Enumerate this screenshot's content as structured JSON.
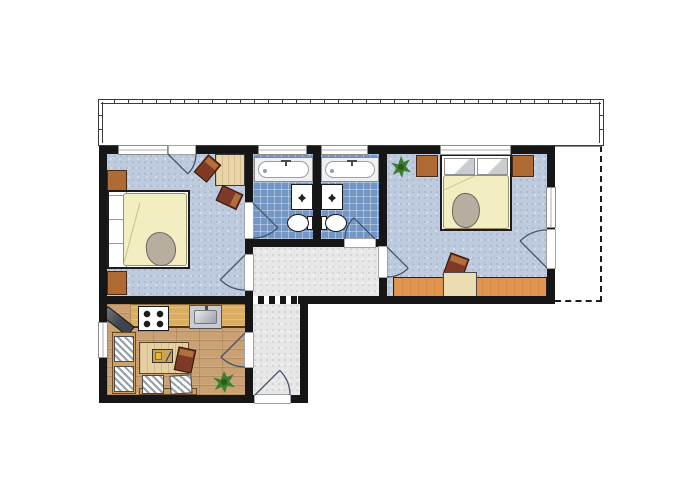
{
  "image_type": "apartment-floor-plan",
  "visible_text": [],
  "rooms": [
    {
      "id": "bedroom-left",
      "floor": "blue-speckle",
      "furniture": [
        "double-bed",
        "nightstand",
        "nightstand",
        "desk",
        "chair",
        "chair"
      ],
      "openings": [
        "window-top",
        "balcony-door-top",
        "door-to-bathroom-left",
        "door-to-hallway"
      ]
    },
    {
      "id": "bathroom-left",
      "floor": "blue-tile",
      "furniture": [
        "bathtub",
        "sink",
        "toilet"
      ],
      "openings": [
        "window-top",
        "door-to-bedroom-left"
      ]
    },
    {
      "id": "bathroom-right",
      "floor": "blue-tile",
      "furniture": [
        "bathtub",
        "sink",
        "toilet"
      ],
      "openings": [
        "window-top",
        "door-to-hallway"
      ]
    },
    {
      "id": "bedroom-right",
      "floor": "blue-speckle",
      "furniture": [
        "double-bed",
        "nightstand",
        "nightstand",
        "plant",
        "sideboard-desk",
        "chair"
      ],
      "openings": [
        "window-top",
        "window-right",
        "balcony-door-right",
        "door-to-hallway"
      ]
    },
    {
      "id": "kitchen",
      "floor": "wood-planks",
      "furniture": [
        "corner-tv",
        "stove",
        "counter",
        "kitchen-sink",
        "bench",
        "cushion",
        "cushion",
        "table",
        "cutting-board",
        "chair",
        "chair-cushion",
        "chair-cushion",
        "plant"
      ],
      "openings": [
        "window-left",
        "door-to-hallway"
      ]
    },
    {
      "id": "hallway",
      "floor": "gray-speckle",
      "furniture": [],
      "openings": [
        "entrance-door-bottom"
      ]
    },
    {
      "id": "terrace",
      "floor": "white",
      "furniture": [],
      "openings": []
    },
    {
      "id": "balcony",
      "floor": "white",
      "furniture": [],
      "openings": []
    }
  ],
  "counts": {
    "windows": 7,
    "interior-doors": 5,
    "balcony-doors": 2,
    "entrance-doors": 1
  },
  "palette": {
    "wall": "#161616",
    "bedroom_floor": "#becbde",
    "bathroom_floor": "#7396c4",
    "hallway_floor": "#e7e7e7",
    "kitchen_floor": "#c9a173",
    "counter_wood": "#d9ad62",
    "furniture_wood": "#b06a33",
    "chair_wood": "#7e3a25",
    "bed_blanket": "#f3eec2",
    "plant_green": "#3f7d2e",
    "door_swing": "#44536b",
    "background": "#ffffff"
  }
}
